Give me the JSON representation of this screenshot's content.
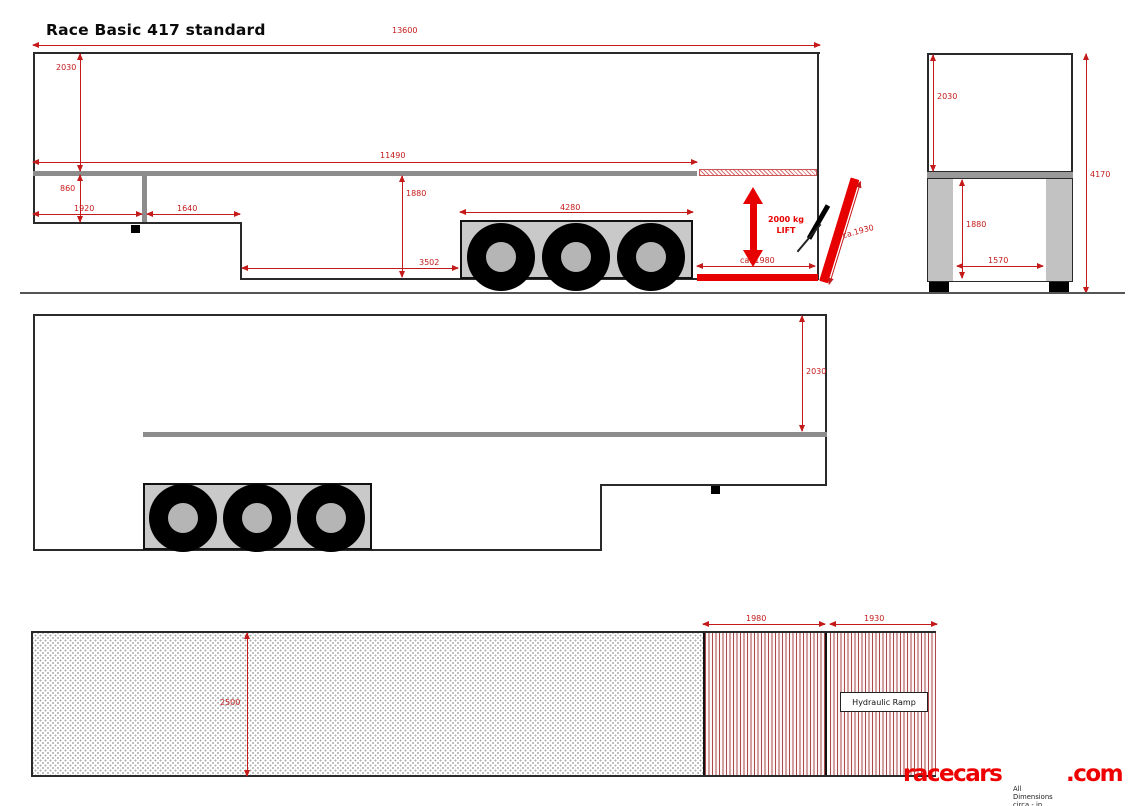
{
  "title": "Race Basic 417 standard",
  "side_view": {
    "total_length": "13600",
    "interior_height": "2030",
    "floor_length": "11490",
    "gooseneck_height": "860",
    "front_section_length": "1920",
    "second_section_length": "1640",
    "rear_interior_height": "1880",
    "lower_deck_length": "3502",
    "wheelbox_length": "4280",
    "lift_platform_length": "ca. 1980",
    "lift_capacity": "2000 kg",
    "lift_word": "LIFT",
    "ramp_length": "ca.1930"
  },
  "rear_view": {
    "upper_interior_height": "2030",
    "lower_interior_height": "1880",
    "inner_width": "1570",
    "total_height": "4170"
  },
  "offside_view": {
    "interior_height": "2030"
  },
  "plan_view": {
    "inner_width": "2500",
    "lift_platform_length": "1980",
    "ramp_length": "1930",
    "ramp_label": "Hydraulic Ramp"
  },
  "branding": {
    "brand_main": "racecars",
    "brand_suffix": ".com",
    "note": "All Dimensions circa - in mm"
  },
  "colors": {
    "dimension_red": "#c41a1a",
    "accent_red": "#e60000",
    "logo_red": "#ee0000",
    "floor_gray": "#8c8c8c",
    "box_gray": "#c9c9c9",
    "outline_black": "#2a2a2a"
  }
}
